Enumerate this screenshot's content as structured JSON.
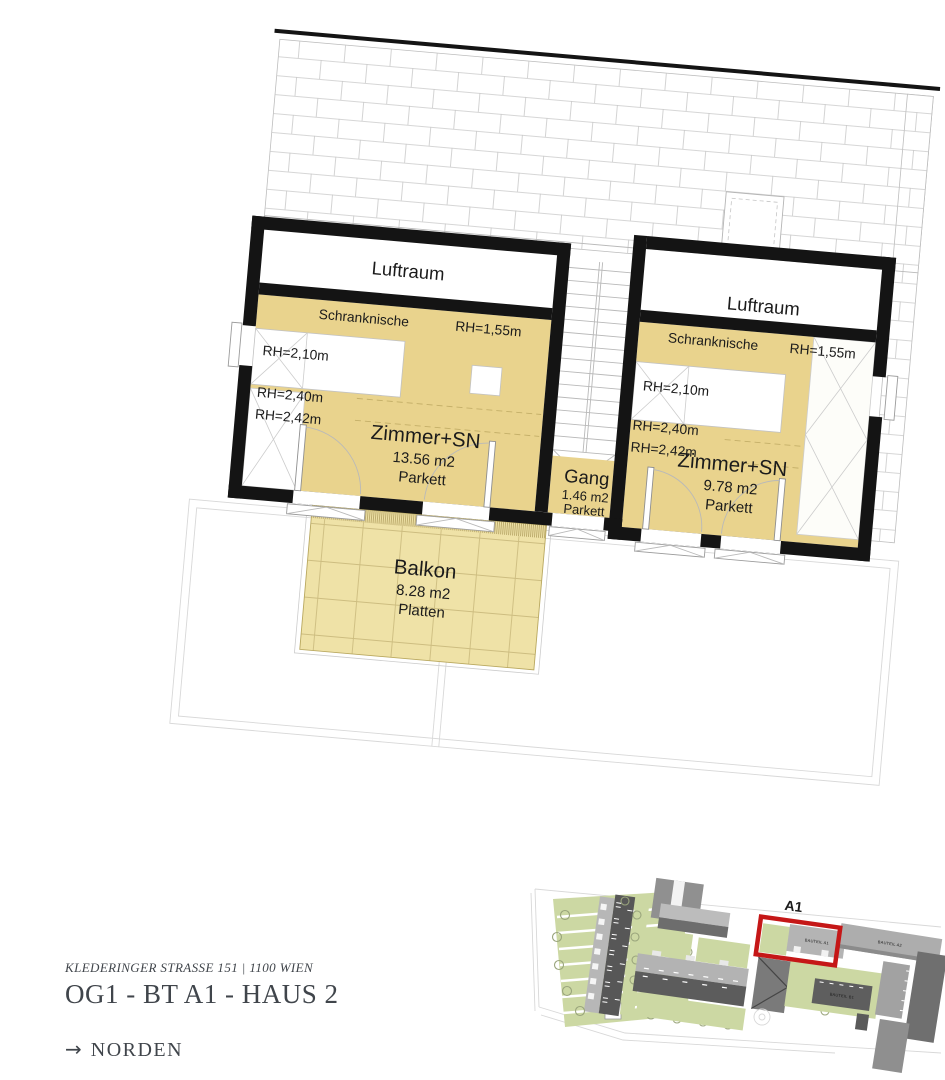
{
  "plan": {
    "left": {
      "luftraum": "Luftraum",
      "schranknische": "Schranknische",
      "schranknische_rh": "RH=1,55m",
      "rh_a": "RH=2,10m",
      "rh_b": "RH=2,40m",
      "rh_c": "RH=2,42m",
      "room": "Zimmer+SN",
      "area": "13.56 m2",
      "floor": "Parkett"
    },
    "gang": {
      "name": "Gang",
      "area": "1.46 m2",
      "floor": "Parkett"
    },
    "right": {
      "luftraum": "Luftraum",
      "schranknische": "Schranknische",
      "schranknische_rh": "RH=1,55m",
      "rh_a": "RH=2,10m",
      "rh_b": "RH=2,40m",
      "rh_c": "RH=2,42m",
      "room": "Zimmer+SN",
      "area": "9.78 m2",
      "floor": "Parkett"
    },
    "balkon": {
      "name": "Balkon",
      "area": "8.28 m2",
      "floor": "Platten"
    }
  },
  "footer": {
    "address": "KLEDERINGER STRASSE 151 | 1100 WIEN",
    "title": "OG1 - BT A1 - HAUS 2",
    "north_arrow": "→",
    "north": "NORDEN"
  },
  "siteplan": {
    "highlight_label": "A1",
    "bauteil_a1": "BAUTEIL A1",
    "bauteil_a2": "BAUTEIL A2",
    "bauteil_b1": "BAUTEIL B1"
  },
  "colors": {
    "room_fill": "#e9d38d",
    "balcony_fill": "#efe2a7",
    "wall": "#141414",
    "highlight_red": "#c51717",
    "site_green": "#ccd8a3",
    "footer_text": "#40454b"
  }
}
